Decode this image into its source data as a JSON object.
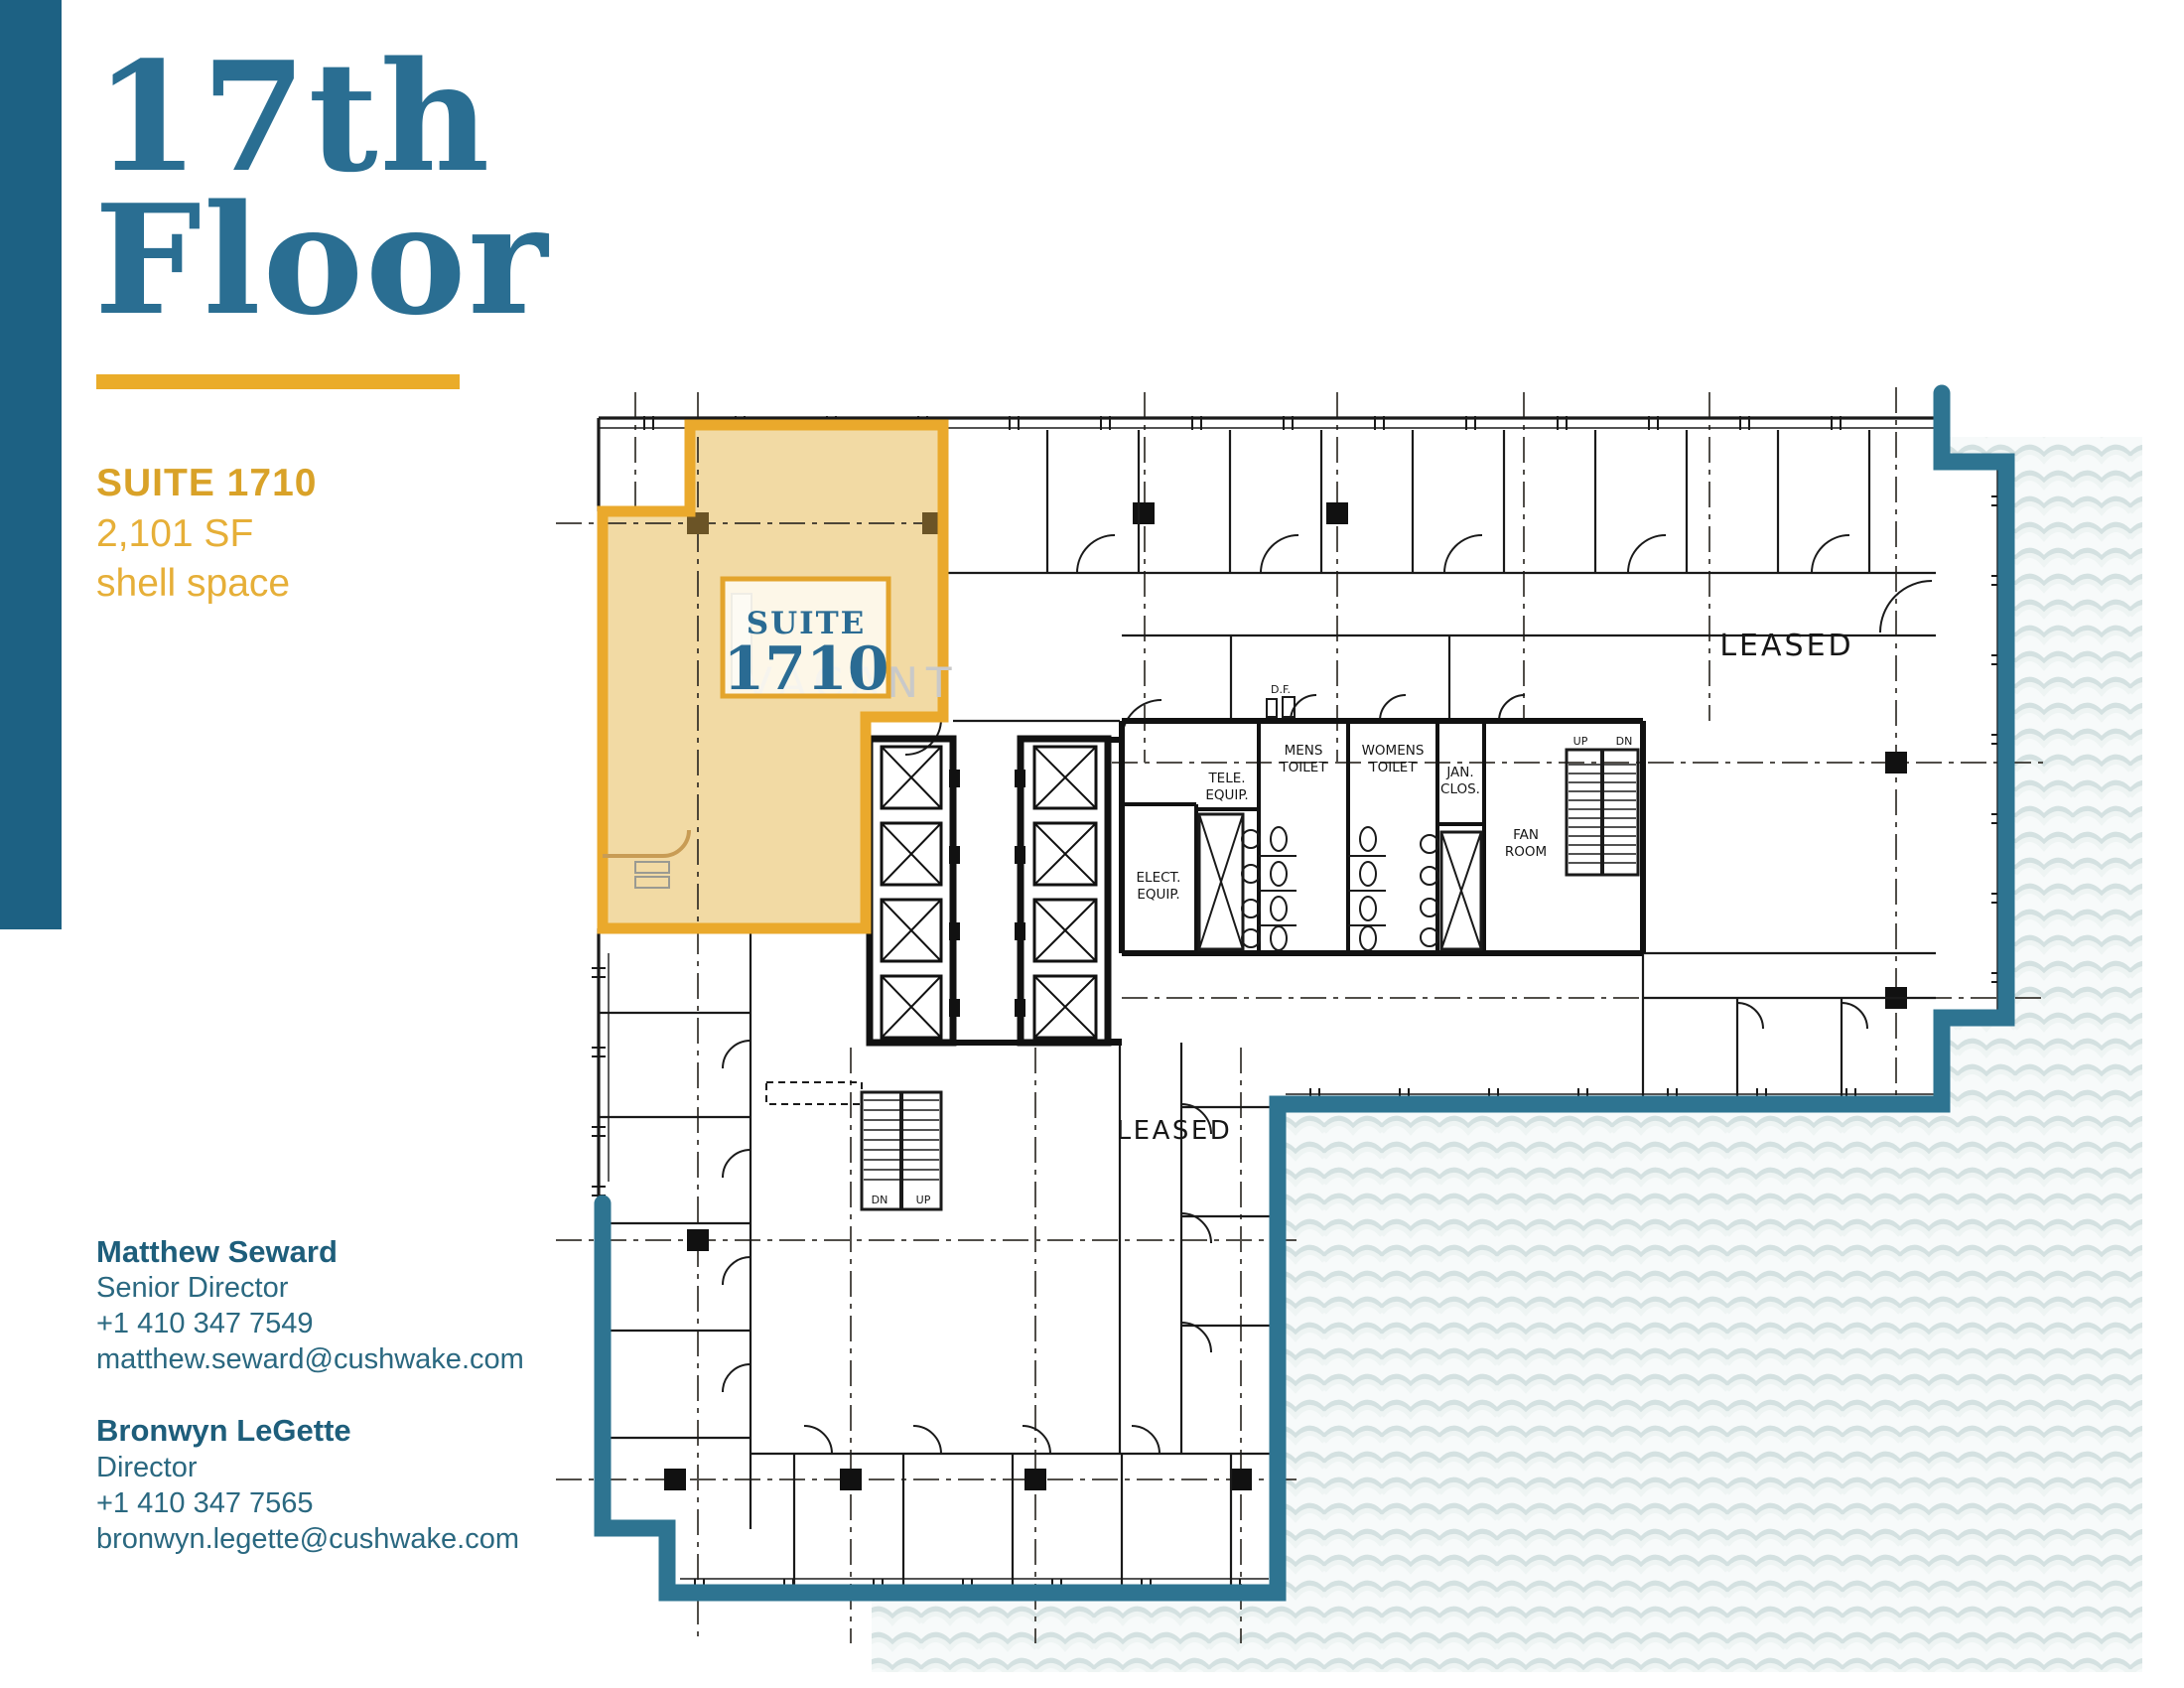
{
  "page": {
    "floor_line1": "17th",
    "floor_line2": "Floor"
  },
  "suite": {
    "heading": "SUITE 1710",
    "area": "2,101 SF",
    "condition": "shell space"
  },
  "contacts": [
    {
      "name": "Matthew Seward",
      "title": "Senior Director",
      "phone": "+1 410 347 7549",
      "email": "matthew.seward@cushwake.com"
    },
    {
      "name": "Bronwyn LeGette",
      "title": "Director",
      "phone": "+1 410 347 7565",
      "email": "bronwyn.legette@cushwake.com"
    }
  ],
  "floorplan": {
    "suite_label": {
      "line1": "SUITE",
      "line2": "1710"
    },
    "vacant": "VACANT",
    "leased_right": "LEASED",
    "leased_bottom": "LEASED",
    "rooms": {
      "df": "D.F.",
      "mens_1": "MENS",
      "mens_2": "TOILET",
      "womens_1": "WOMENS",
      "womens_2": "TOILET",
      "tele_1": "TELE.",
      "tele_2": "EQUIP.",
      "elect_1": "ELECT.",
      "elect_2": "EQUIP.",
      "jan_1": "JAN.",
      "jan_2": "CLOS.",
      "fan_1": "FAN",
      "fan_2": "ROOM",
      "up": "UP",
      "dn": "DN"
    }
  },
  "colors": {
    "title_blue": "#2A6E92",
    "accent_gold": "#EAAC29",
    "outline_blue": "#2E7491",
    "suite_fill": "#F2DAA4",
    "contact_teal": "#26637F"
  }
}
